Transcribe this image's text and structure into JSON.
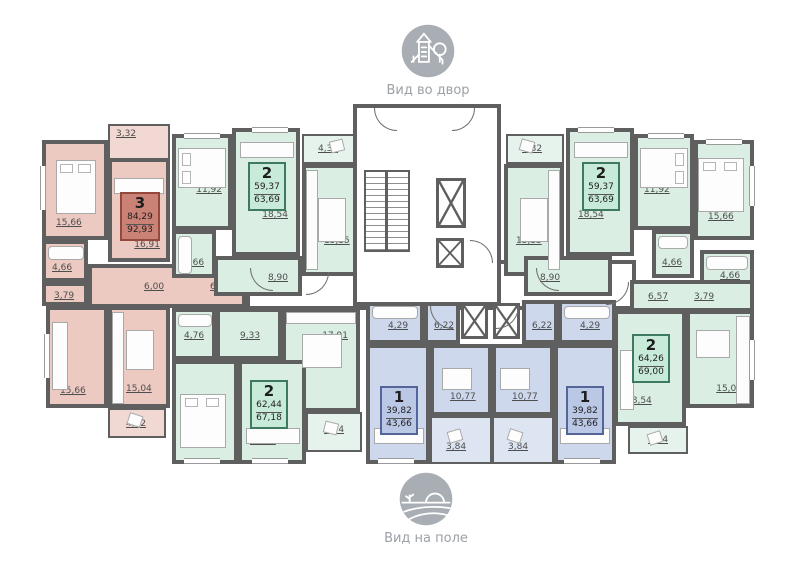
{
  "view_labels": {
    "top": "Вид во двор",
    "bottom": "Вид на поле"
  },
  "apartments": {
    "a3": {
      "rooms": "3",
      "living": "84,29",
      "total": "92,93"
    },
    "a2tl": {
      "rooms": "2",
      "living": "59,37",
      "total": "63,69"
    },
    "a2tr": {
      "rooms": "2",
      "living": "59,37",
      "total": "63,69"
    },
    "a2r": {
      "rooms": "2",
      "living": "64,26",
      "total": "69,00"
    },
    "a2bl": {
      "rooms": "2",
      "living": "62,44",
      "total": "67,18"
    },
    "a1l": {
      "rooms": "1",
      "living": "39,82",
      "total": "43,66"
    },
    "a1r": {
      "rooms": "1",
      "living": "39,82",
      "total": "43,66"
    }
  },
  "room_areas": {
    "p_balc_top": "3,32",
    "p_bed1": "15,66",
    "p_living": "16,91",
    "p_bath": "4,66",
    "p_hall": "3,79",
    "p_cor1": "6,00",
    "p_cor2": "6,57",
    "p_bed2": "15,66",
    "p_kitchen": "15,04",
    "p_balc_bot": "4,32",
    "ga_bed": "11,92",
    "ga_living": "18,54",
    "ga_balc": "4,32",
    "ga_kitchen": "15,35",
    "ga_bath": "4,66",
    "ga_hall": "8,90",
    "gb_bed": "11,92",
    "gb_living": "18,54",
    "gb_balc": "4,32",
    "gb_kitchen": "15,35",
    "gb_bath": "4,66",
    "gb_hall": "8,90",
    "gc_bed": "15,66",
    "gc_bath": "4,66",
    "gc_cor1": "6,57",
    "gc_cor2": "3,79",
    "gc_living": "18,54",
    "gc_kitchen": "15,04",
    "gc_balc": "4,74",
    "gd_bath": "4,76",
    "gd_hall": "9,33",
    "gd_kitchen": "17,91",
    "gd_bed": "11,90",
    "gd_living": "18,54",
    "gd_balc": "4,74",
    "be_bath": "4,29",
    "be_hall": "6,22",
    "be_kitchen": "10,77",
    "be_living": "18,54",
    "be_balc": "3,84",
    "bf_bath": "4,29",
    "bf_hall": "6,22",
    "bf_kitchen": "10,77",
    "bf_living": "18,54",
    "bf_balc": "3,84"
  },
  "colors": {
    "apartment_pink": "#ecc9c1",
    "apartment_green": "#daeee3",
    "apartment_blue": "#cdd8ec",
    "wall": "#5f5f5f",
    "label_box_pink": "#ca8276",
    "label_box_green": "#c8ead9",
    "label_box_blue": "#bac8e6",
    "icon_gray": "#a9aeb4"
  }
}
